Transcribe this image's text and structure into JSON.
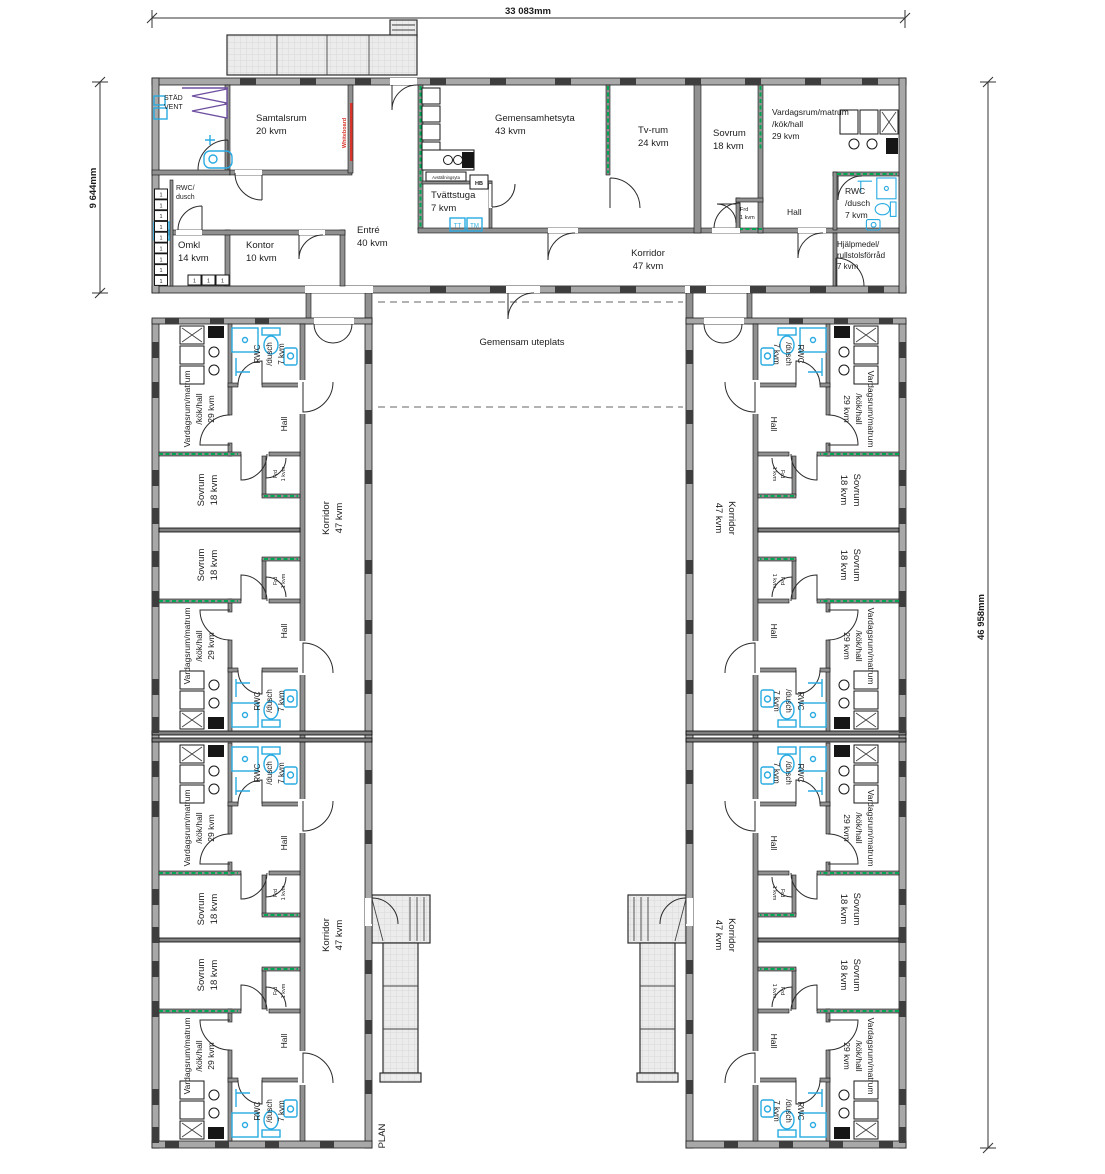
{
  "plan": {
    "label": "PLAN"
  },
  "dimensions": {
    "top_width": "33 083mm",
    "left_height": "9 644mm",
    "right_height": "46 958mm"
  },
  "courtyard": {
    "label": "Gemensam uteplats"
  },
  "rooms": {
    "samtalsrum": {
      "name": "Samtalsrum",
      "area": "20 kvm"
    },
    "omkl": {
      "name": "Omkl",
      "area": "14 kvm"
    },
    "kontor": {
      "name": "Kontor",
      "area": "10 kvm"
    },
    "entre": {
      "name": "Entré",
      "area": "40 kvm"
    },
    "gemensamhetsyta": {
      "name": "Gemensamhetsyta",
      "area": "43 kvm"
    },
    "tvattstuga": {
      "name": "Tvättstuga",
      "area": "7 kvm"
    },
    "tvrum": {
      "name": "Tv-rum",
      "area": "24 kvm"
    },
    "sovrum": {
      "name": "Sovrum",
      "area": "18 kvm"
    },
    "vardagsrum": {
      "line1": "Vardagsrum/matrum",
      "line2": "/kök/hall",
      "area": "29 kvm"
    },
    "hall": {
      "name": "Hall"
    },
    "frd": {
      "name": "Frd",
      "area": "1 kvm"
    },
    "rwc": {
      "line1": "RWC",
      "line2": "/dusch",
      "area": "7 kvm"
    },
    "korridor": {
      "name": "Korridor",
      "area": "47 kvm"
    },
    "hjalpmedel": {
      "line1": "Hjälpmedel/",
      "line2": "rullstolsförråd",
      "area": "7 kvm"
    },
    "stad_vent": {
      "line1": "STÄD",
      "line2": "VENT"
    },
    "rwc_entre": {
      "line1": "RWC/",
      "line2": "dusch"
    }
  },
  "annotations": {
    "whiteboard": "Whiteboard",
    "avstallningsyta": "Avställningsyta",
    "step": "1"
  },
  "appliances": {
    "tt": "TT",
    "tm": "TM",
    "hb": "HB"
  },
  "colors": {
    "fixture_blue": "#29ABE2",
    "new_wall_green": "#00A651",
    "whiteboard_red": "#D9342B",
    "vent_purple": "#6E4FA0"
  }
}
